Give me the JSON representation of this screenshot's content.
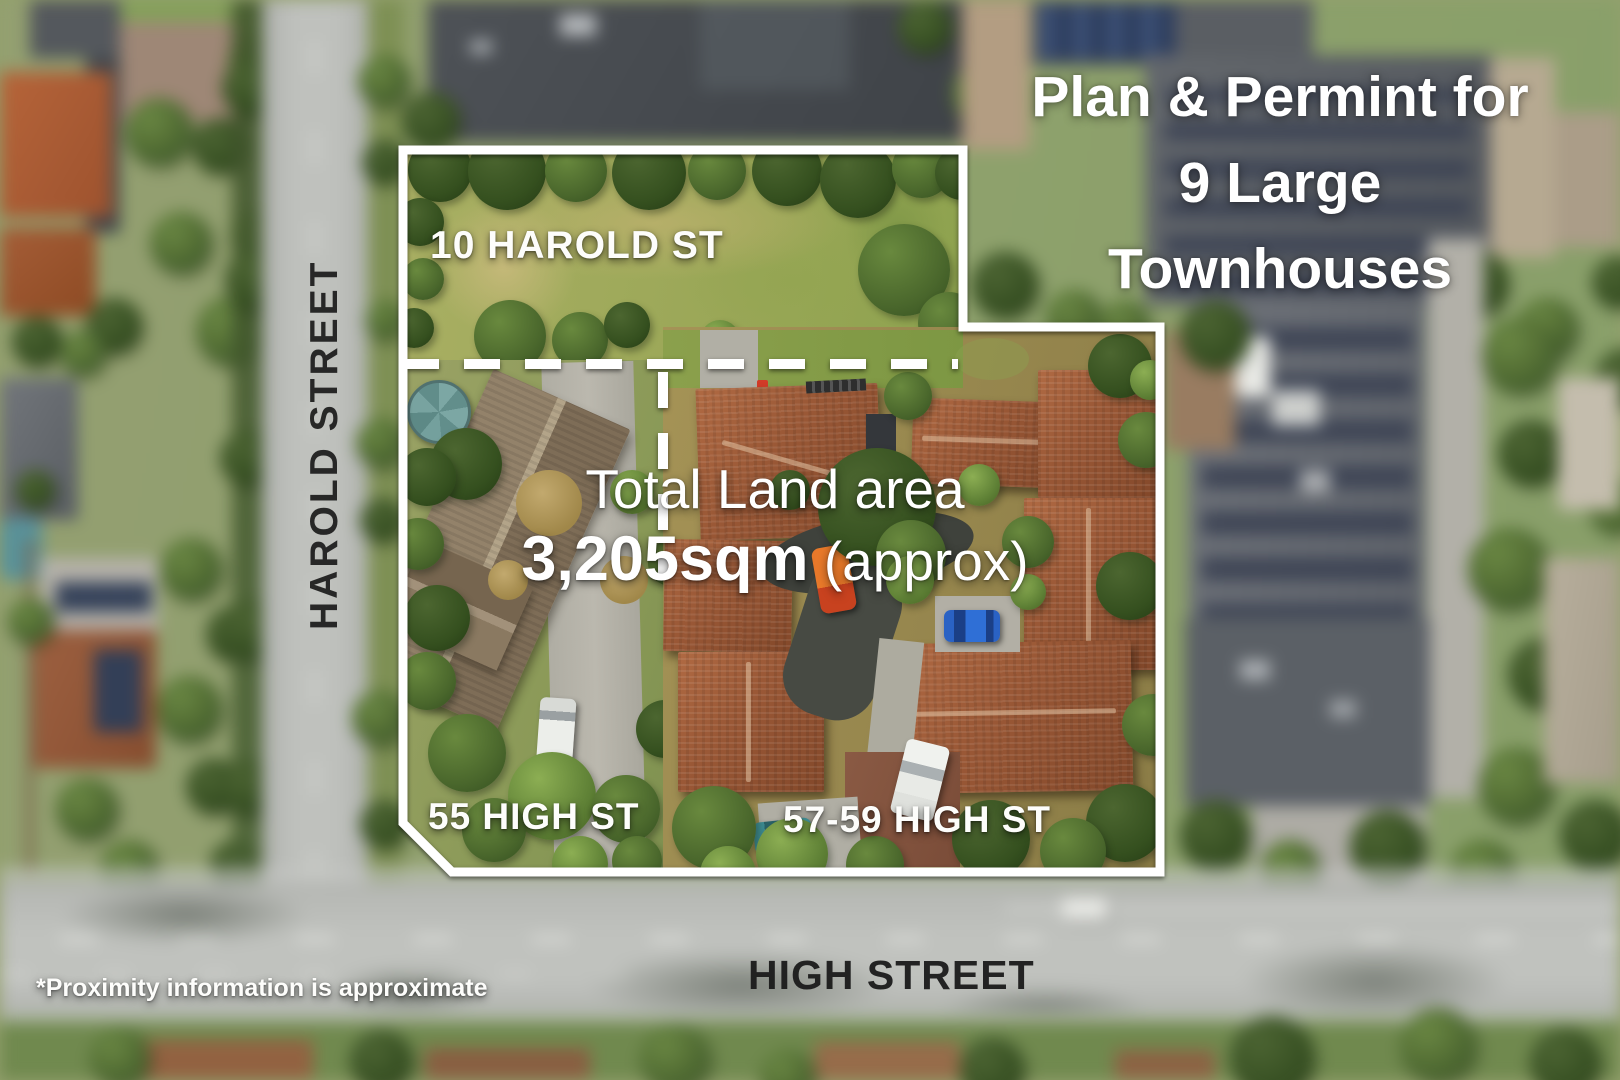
{
  "overlay": {
    "headline": {
      "lines": [
        "Plan & Permint for",
        "9 Large",
        "Townhouses"
      ]
    },
    "land_area": {
      "title": "Total Land area",
      "value": "3,205sqm",
      "qualifier": " (approx)"
    },
    "parcel_labels": {
      "harold": "10 HAROLD ST",
      "high_55": "55 HIGH ST",
      "high_57_59": "57-59 HIGH ST"
    },
    "street_labels": {
      "harold": "HAROLD STREET",
      "high": "HIGH STREET"
    },
    "disclaimer": "*Proximity information is approximate",
    "colors": {
      "boundary": "#ffffff",
      "overlay_text": "#ffffff",
      "street_text": "#1c1c1c"
    }
  }
}
